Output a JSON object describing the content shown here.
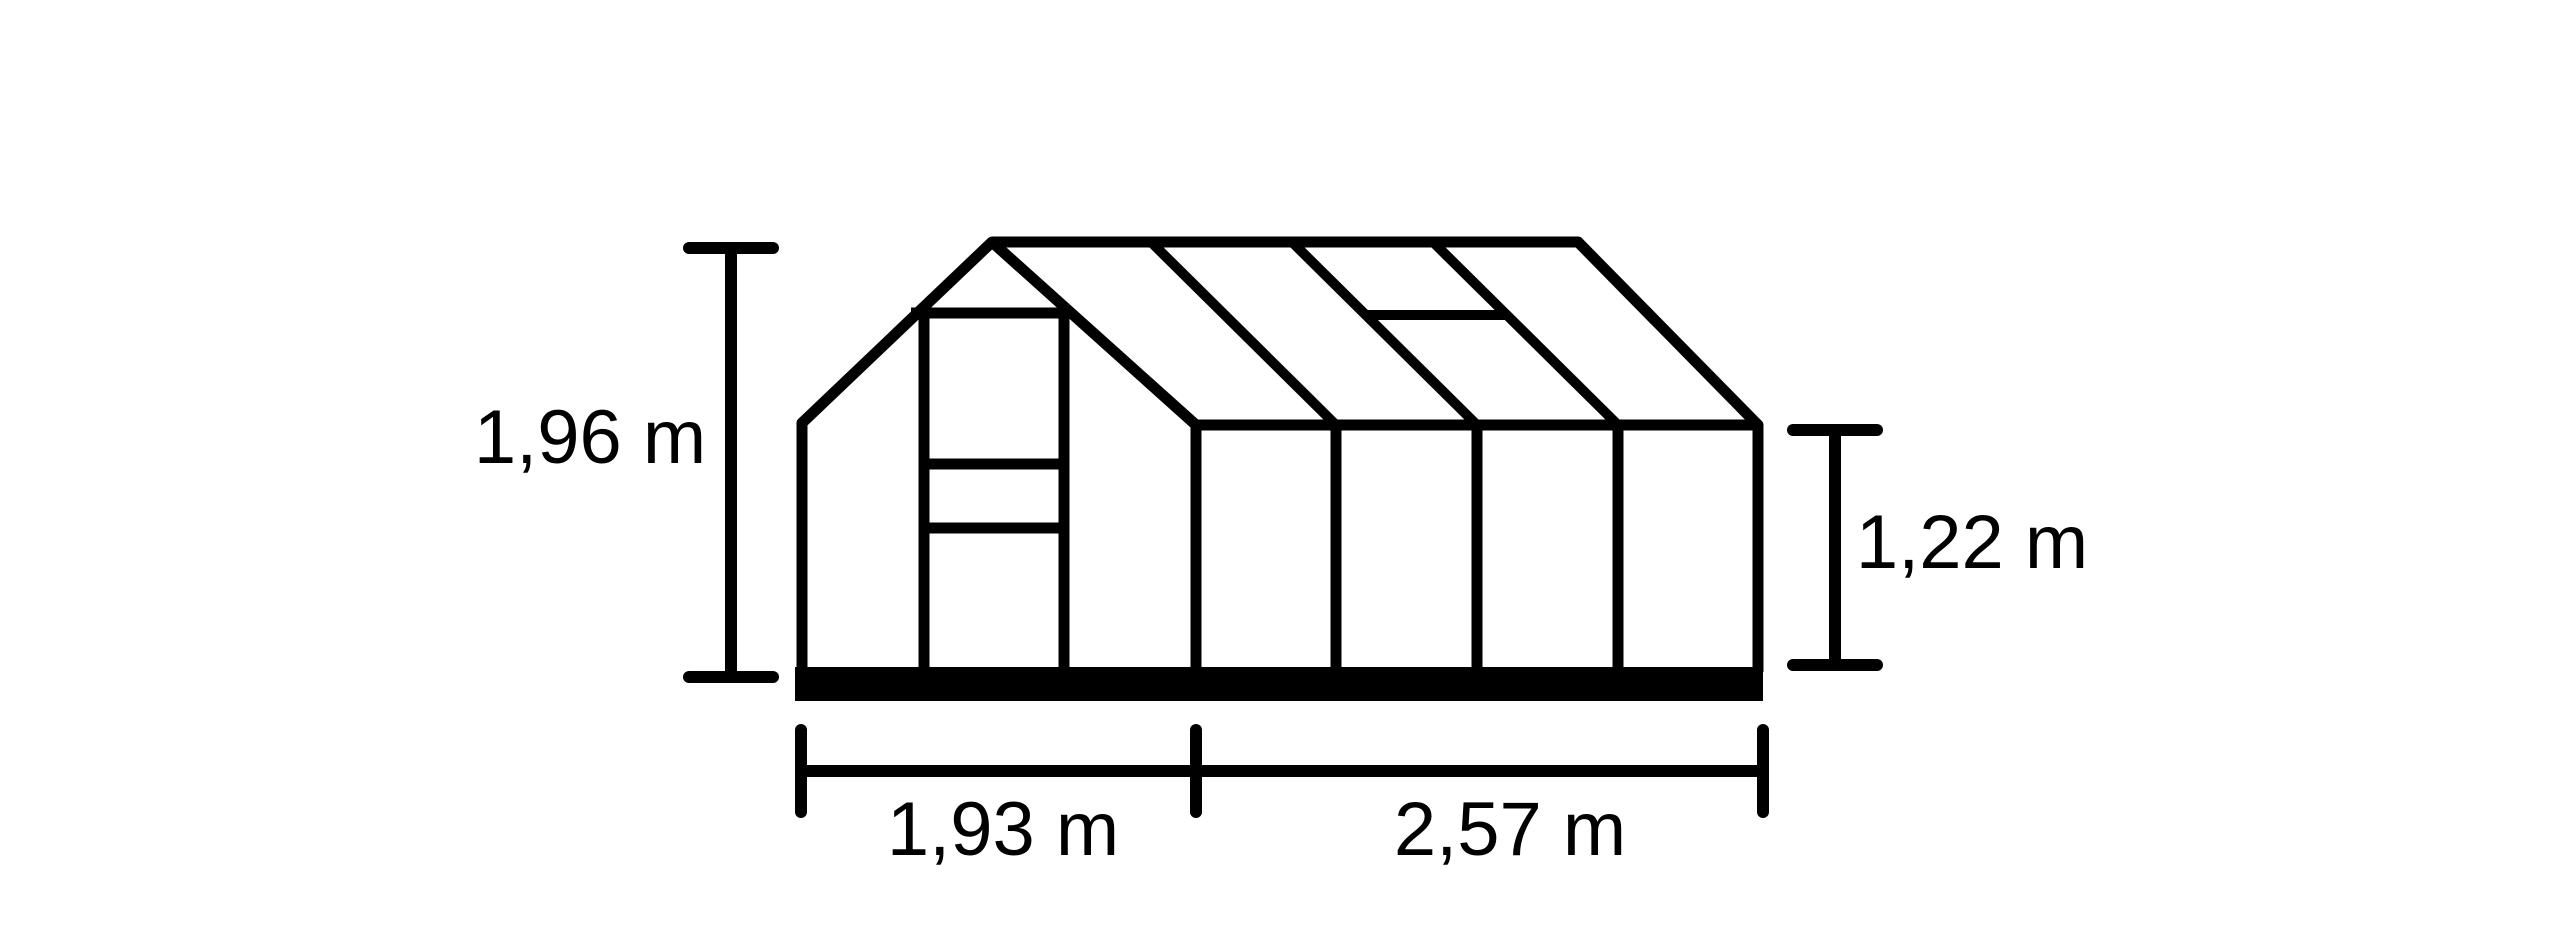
{
  "diagram": {
    "name": "Greenhouse dimensions technical drawing",
    "background": "#ffffff",
    "line_color": "#000000",
    "text_color": "#000000",
    "unit": "m",
    "dimensions": {
      "total_height": "1,96 m",
      "side_height": "1,22 m",
      "gable_width": "1,93 m",
      "side_length": "2,57 m"
    }
  }
}
